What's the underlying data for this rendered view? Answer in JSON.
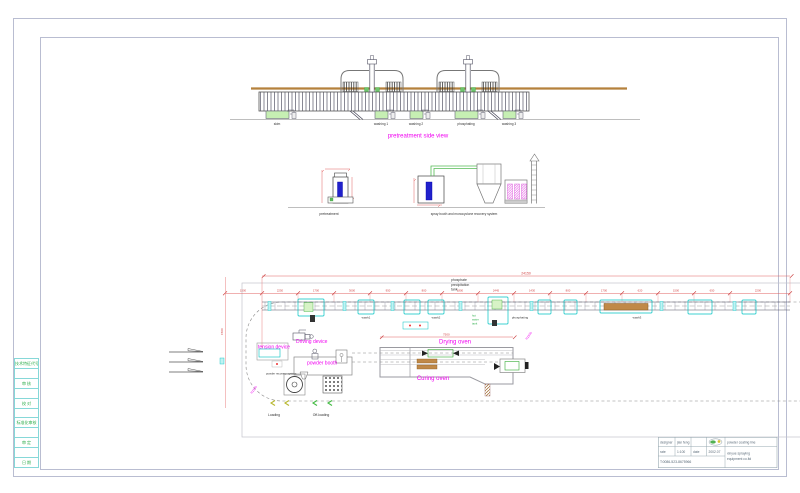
{
  "side_view": {
    "title": "pretreatment side view",
    "tank_labels": [
      "skim",
      "washing 1",
      "washing 2",
      "phosphating",
      "washing 3"
    ]
  },
  "elevation": {
    "pretreatment": "pretreatment",
    "spray_system": "spray booth and monocyclone recovery system"
  },
  "plan": {
    "total_dim": "24150",
    "oven_dim": "7500",
    "left_dim": "1500",
    "radius_left": "R1500",
    "radius_right": "R1500",
    "dims": [
      "1500",
      "2250",
      "1700",
      "3000",
      "950",
      "800",
      "1800",
      "2445",
      "1430",
      "800",
      "1700",
      "620",
      "1500",
      "650",
      "2200"
    ],
    "phosphate_note": [
      "phosphate",
      "precipitation",
      "tank"
    ],
    "hot_water_note": [
      "hot",
      "water",
      "tank"
    ],
    "tension_device": "tension device",
    "driving_device": "Driving device",
    "powder_booth": "powder booth",
    "powder_recovery": "powder recovery system",
    "drying_oven": "Drying oven",
    "curing_oven": "Curing oven",
    "loading": "Loading",
    "off_loading": "Off-loading",
    "wash1": "wash1",
    "wash2": "wash2",
    "phosphating": "phosphating",
    "wash3": "wash3"
  },
  "title_block": {
    "designer_label": "designer",
    "designer_value": "jian feng",
    "rate_label": "rate",
    "rate_value": "1:100",
    "date_label": "date",
    "date_value": "2002.07",
    "phone": "T:0086-523-8675966",
    "product": "powder coating line",
    "company_line1": "xinyue spraying",
    "company_line2": "equipment co.ltd"
  },
  "left_strip": {
    "cells": [
      "技术特征代号",
      "",
      "审 核",
      "",
      "校 对",
      "",
      "标准化审核",
      "",
      "审 定",
      "",
      "日 期"
    ]
  }
}
